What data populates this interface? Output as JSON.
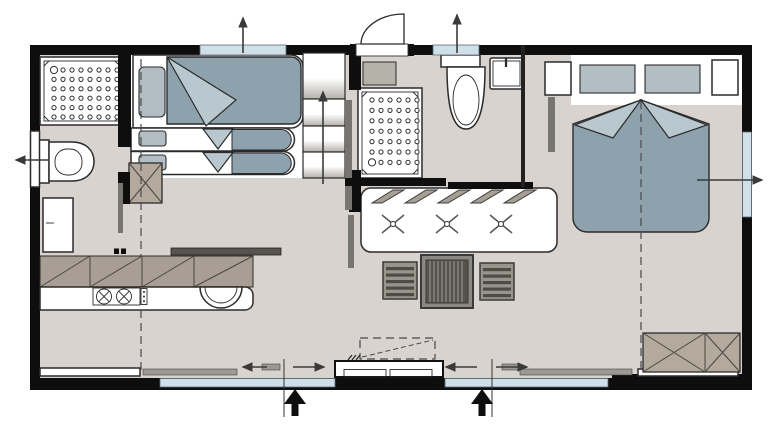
{
  "palette": {
    "wall": "#0e0e0e",
    "floor": "#d8d3ce",
    "glass": "#cfe0e9",
    "blanket": "#8da2ac",
    "blanket_light": "#b9c8ce",
    "pillow": "#b2bec4",
    "cabinet": "#a89e94",
    "wardrobe": "#b3a99d",
    "slidebar": "#76756f",
    "counter_dark": "#56544e",
    "arrow": "#3a3a3a",
    "outline": "#2b2b2b"
  },
  "plan": {
    "canvas": {
      "width": 781,
      "height": 434
    },
    "shower_trays": [
      {
        "name": "left-bathroom-shower-tray",
        "x": 54,
        "y": 70,
        "cols": 8,
        "rows": 6,
        "dx": 9,
        "dy": 9.4,
        "big": "tl"
      },
      {
        "name": "middle-bathroom-shower-tray",
        "x": 372,
        "y": 100,
        "cols": 6,
        "rows": 7,
        "dx": 9,
        "dy": 10.4,
        "big": "bl"
      }
    ],
    "fixtures": [
      "shower-tray-left",
      "toilet-left",
      "washbasin-left",
      "shower-tray-middle",
      "toilet-middle",
      "washbasin-middle",
      "double-bed-left-with-folded-blanket",
      "single-bed-upper",
      "single-bed-lower",
      "shelf-unit-with-arrow",
      "wardrobe-x-left",
      "kitchen-wall-cabinets",
      "hob-two-burners",
      "kitchen-sink",
      "counter-slab",
      "dining-table-with-three-x-marks",
      "slatted-chair-left",
      "slatted-chair-center",
      "slatted-chair-right",
      "double-bed-right-with-two-pillows",
      "nightstand-left",
      "nightstand-right",
      "wardrobe-x-right",
      "sliding-entrance-door",
      "fold-out-step-dashed",
      "bench-left",
      "bench-right"
    ],
    "kitchen": {
      "burner_count": 2,
      "cabinet_cells": 4
    },
    "dining": {
      "x_marks": 3,
      "chairs": 3,
      "louver_leaves": 5
    },
    "wardrobes": {
      "left_cells": 1,
      "right_cells": 2
    },
    "windows": [
      {
        "side": "top",
        "over": "left-bedroom"
      },
      {
        "side": "top",
        "over": "middle-bathroom"
      },
      {
        "side": "left",
        "over": "left-bathroom"
      },
      {
        "side": "right",
        "over": "right-bedroom"
      },
      {
        "side": "bottom",
        "over": "kitchen-living"
      },
      {
        "side": "bottom",
        "over": "living-right"
      }
    ],
    "vent_arrows": [
      {
        "dir": "up",
        "at": "top-left-window"
      },
      {
        "dir": "up",
        "at": "top-middle-window"
      },
      {
        "dir": "left",
        "at": "left-wall-window"
      },
      {
        "dir": "right",
        "at": "right-wall-window"
      }
    ],
    "entrance": {
      "sliding_panels": 2,
      "slide_arrows": [
        "left",
        "right",
        "left",
        "right"
      ],
      "entry_arrows": 2
    },
    "section_lines": {
      "dashed_vertical": 3
    }
  }
}
